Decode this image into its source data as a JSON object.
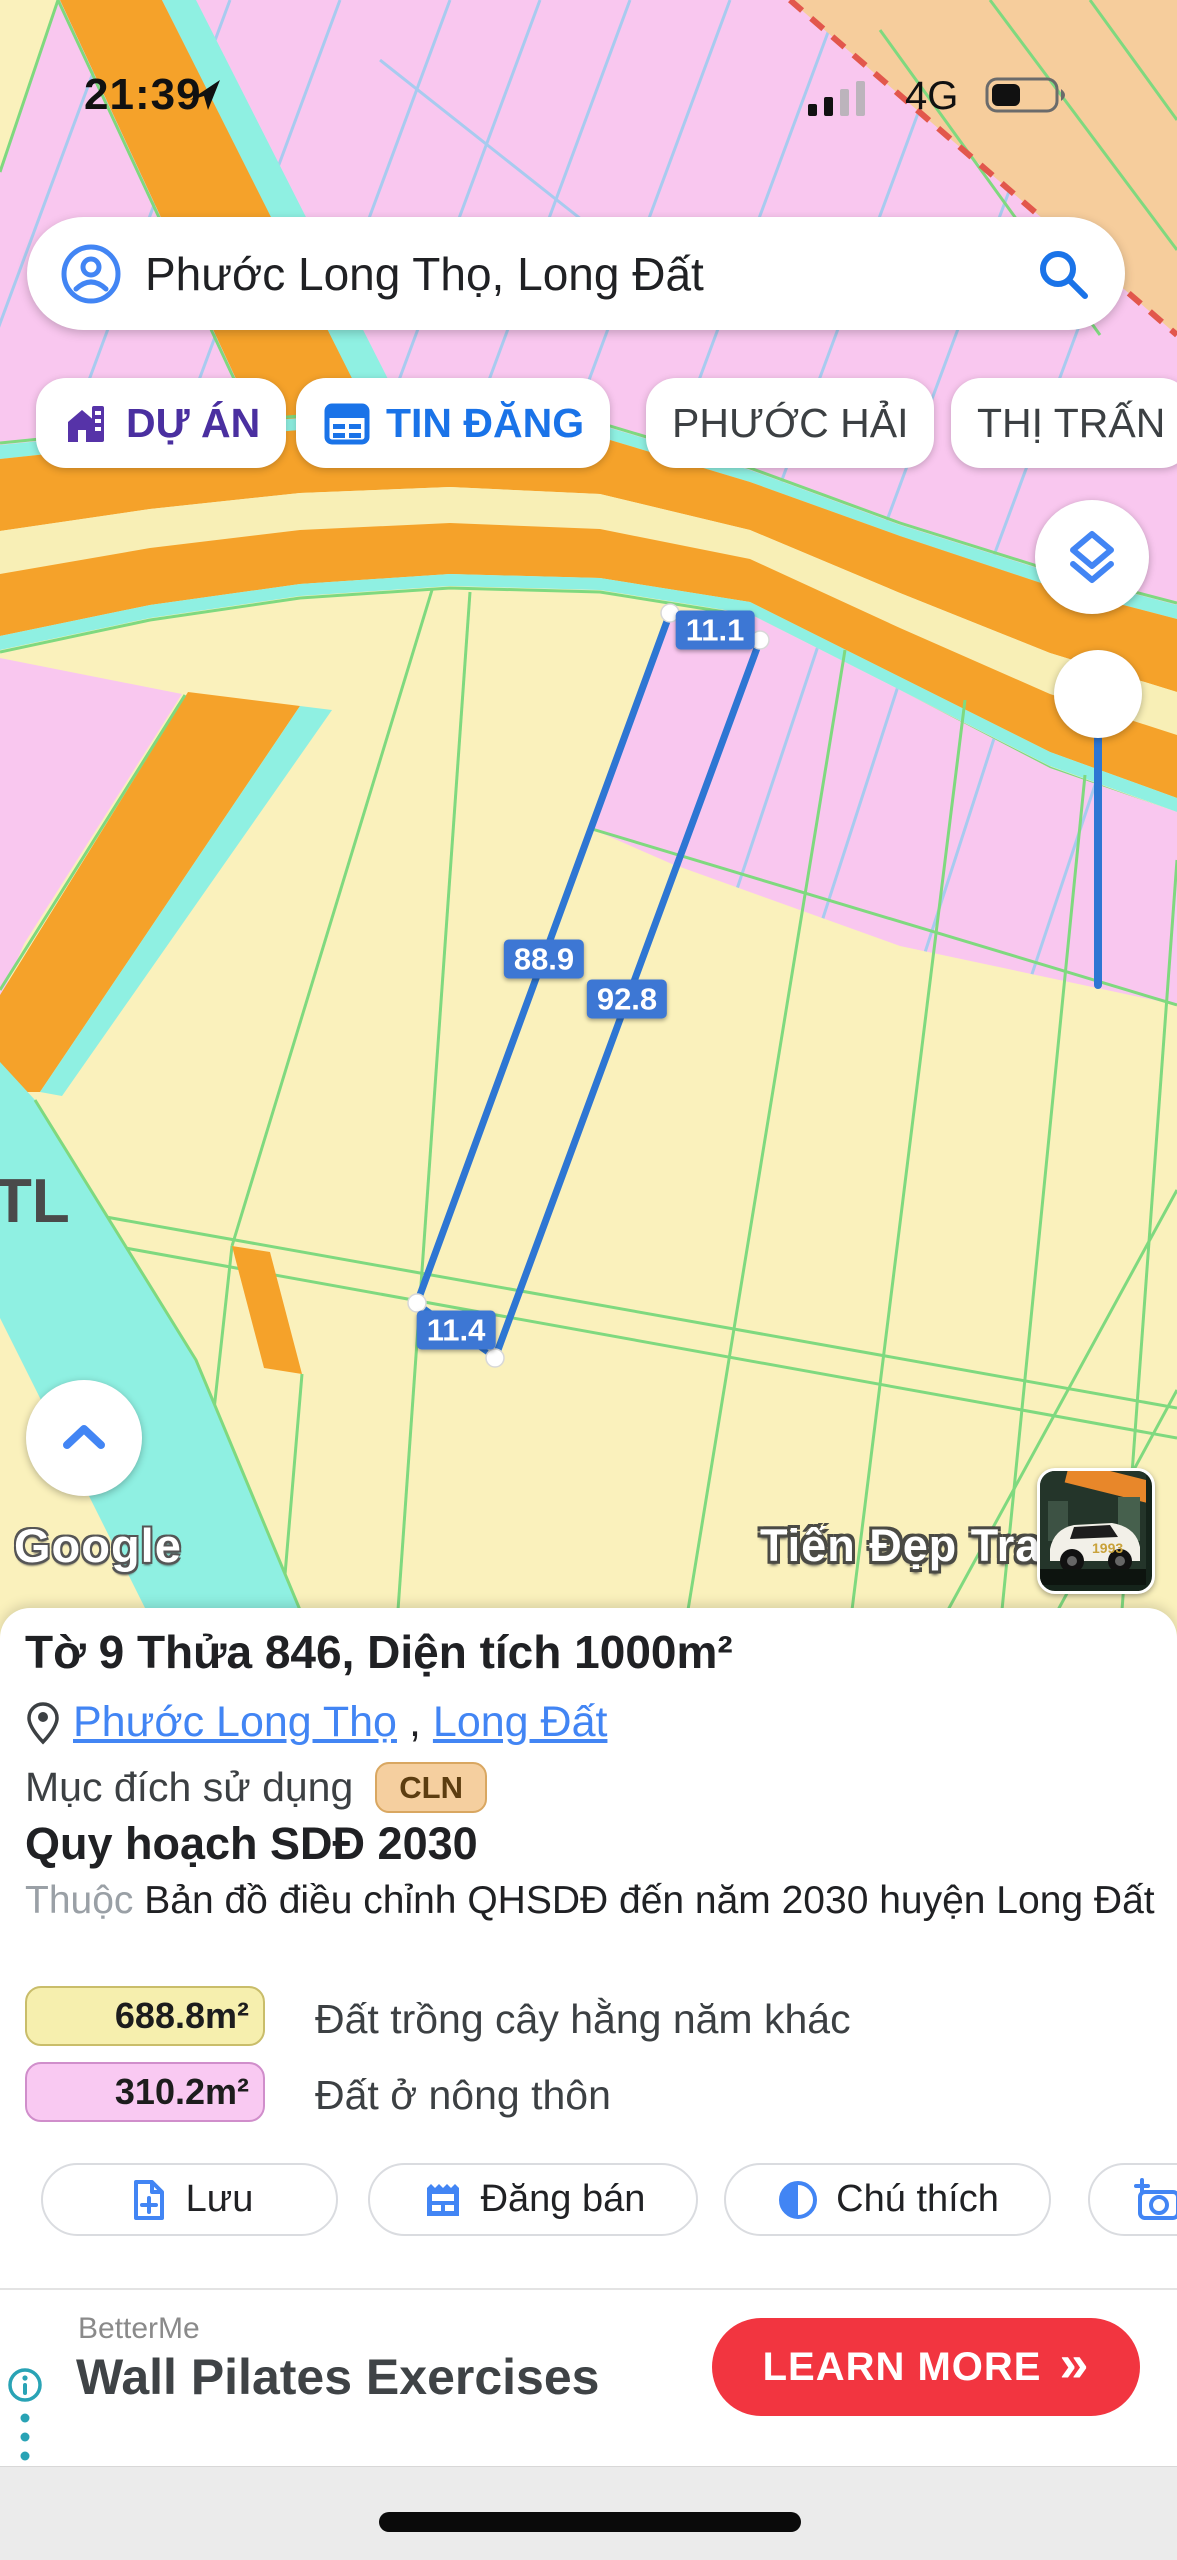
{
  "status_bar": {
    "time": "21:39",
    "network": "4G",
    "battery_percent_visual": 40
  },
  "search": {
    "value": "Phước Long Thọ, Long Đất"
  },
  "chips": [
    {
      "label": "DỰ ÁN"
    },
    {
      "label": "TIN ĐĂNG"
    },
    {
      "label": "PHƯỚC HẢI"
    },
    {
      "label": "THỊ TRẤN"
    }
  ],
  "map": {
    "measurements": {
      "top": "11.1",
      "left": "88.9",
      "right": "92.8",
      "bottom": "11.4"
    },
    "road_label": "TL",
    "google_logo": "Google",
    "watermark": "Tiến Đẹp Trai",
    "car_label": "1993",
    "colors": {
      "residential_pink": "#F9C7EF",
      "crop_yellow": "#FAF1BC",
      "road_orange": "#F5A22A",
      "water_cyan": "#8FF0E2",
      "boundary_peach": "#F6CD9C",
      "parcel_blue": "#2E76D3"
    }
  },
  "panel": {
    "title": "Tờ 9 Thửa 846, Diện tích 1000m²",
    "location": {
      "link1": "Phước Long Thọ",
      "separator": ",",
      "link2": "Long Đất"
    },
    "purpose_label": "Mục đích sử dụng",
    "purpose_code": "CLN",
    "plan_title": "Quy hoạch SDĐ 2030",
    "belongs_label": "Thuộc",
    "belongs_text": "Bản đồ điều chỉnh QHSDĐ đến năm 2030 huyện Long Đất",
    "legend": [
      {
        "area": "688.8m²",
        "label": "Đất trồng cây hằng năm khác",
        "color": "#F6EFAE"
      },
      {
        "area": "310.2m²",
        "label": "Đất ở nông thôn",
        "color": "#F9C9F2"
      }
    ],
    "actions": [
      {
        "label": "Lưu"
      },
      {
        "label": "Đăng bán"
      },
      {
        "label": "Chú thích"
      }
    ]
  },
  "ad": {
    "brand": "BetterMe",
    "headline": "Wall Pilates Exercises",
    "cta": "LEARN MORE",
    "cta_arrows": "»",
    "cta_color": "#F23540"
  }
}
